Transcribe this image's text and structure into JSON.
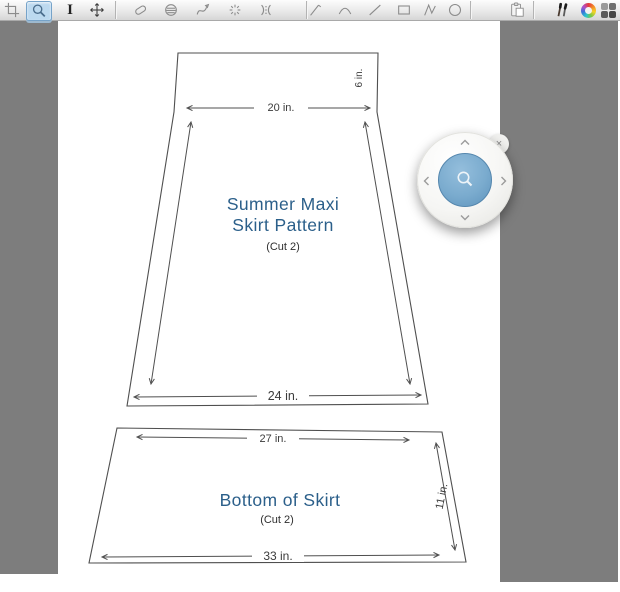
{
  "app": {
    "selected_tool": "zoom"
  },
  "toolbar": {
    "text_tool_glyph": "I",
    "tools": [
      "crop",
      "zoom",
      "text",
      "move",
      "eraser",
      "stamp",
      "curve-pen",
      "scatter",
      "trim-marks",
      "pencil",
      "arc",
      "line",
      "rectangle",
      "polyline",
      "ellipse",
      "paste",
      "brushes",
      "color-wheel",
      "palette"
    ]
  },
  "canvas": {
    "pieces": [
      {
        "title_lines": [
          "Summer Maxi",
          "Skirt Pattern"
        ],
        "cut_note": "(Cut 2)",
        "dimensions": {
          "top": "20 in.",
          "side": "6 in.",
          "bottom": "24 in."
        }
      },
      {
        "title_lines": [
          "Bottom of Skirt"
        ],
        "cut_note": "(Cut 2)",
        "dimensions": {
          "top": "27 in.",
          "side": "11 in.",
          "bottom": "33 in."
        }
      }
    ]
  },
  "magnifier": {
    "close_glyph": "×"
  },
  "colors": {
    "title_text": "#2b5f8a",
    "line": "#4f4f4f",
    "workspace_gray": "#7d7d7d",
    "tool_highlight": "#bcd9ef",
    "magnifier_blue": "#6f9fc6"
  }
}
